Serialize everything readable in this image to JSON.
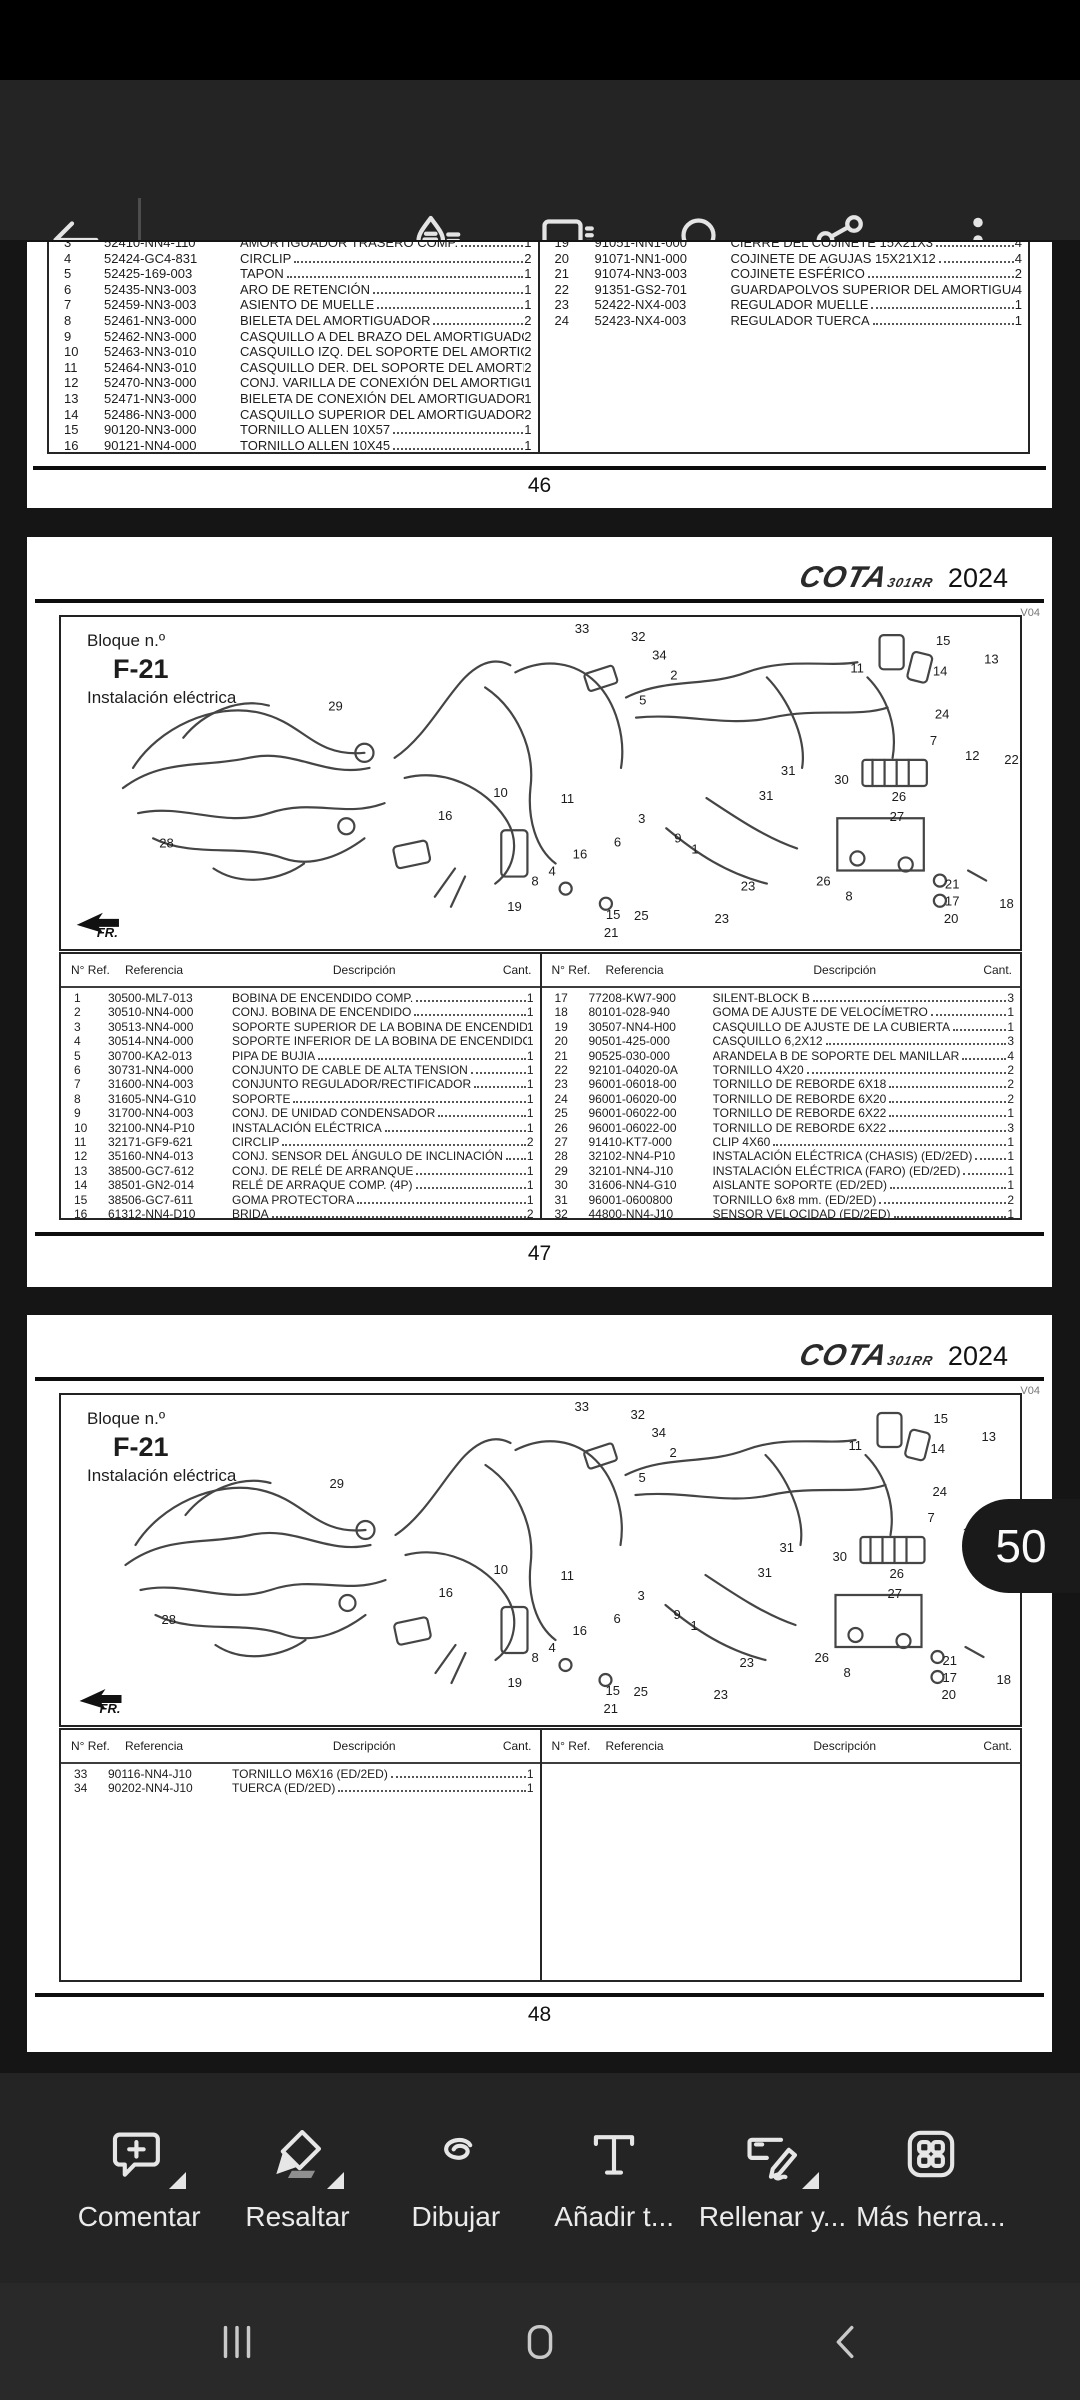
{
  "top_toolbar": {
    "icons": [
      "back-icon",
      "annotations-icon",
      "comments-icon",
      "search-icon",
      "share-icon",
      "overflow-menu-icon"
    ]
  },
  "table_headers": {
    "num": "N° Ref.",
    "ref": "Referencia",
    "desc": "Descripción",
    "qty": "Cant."
  },
  "diagram": {
    "block_label": "Bloque n.º",
    "block_code": "F-21",
    "block_title": "Instalación eléctrica",
    "brand": "COTA",
    "brand_sub": "301RR",
    "year": "2024",
    "version": "V04",
    "fr_label": "FR.",
    "callouts": [
      {
        "n": "33",
        "x": 509,
        "y": 16
      },
      {
        "n": "32",
        "x": 565,
        "y": 24
      },
      {
        "n": "34",
        "x": 586,
        "y": 42
      },
      {
        "n": "2",
        "x": 604,
        "y": 62
      },
      {
        "n": "15",
        "x": 868,
        "y": 28
      },
      {
        "n": "13",
        "x": 916,
        "y": 46
      },
      {
        "n": "11",
        "x": 783,
        "y": 55
      },
      {
        "n": "14",
        "x": 865,
        "y": 58
      },
      {
        "n": "5",
        "x": 573,
        "y": 87
      },
      {
        "n": "29",
        "x": 264,
        "y": 93
      },
      {
        "n": "24",
        "x": 867,
        "y": 101
      },
      {
        "n": "7",
        "x": 862,
        "y": 127
      },
      {
        "n": "12",
        "x": 897,
        "y": 142
      },
      {
        "n": "22",
        "x": 936,
        "y": 146
      },
      {
        "n": "31",
        "x": 714,
        "y": 157
      },
      {
        "n": "30",
        "x": 767,
        "y": 166
      },
      {
        "n": "31",
        "x": 692,
        "y": 182
      },
      {
        "n": "26",
        "x": 824,
        "y": 183
      },
      {
        "n": "27",
        "x": 822,
        "y": 203
      },
      {
        "n": "10",
        "x": 428,
        "y": 179
      },
      {
        "n": "16",
        "x": 373,
        "y": 202
      },
      {
        "n": "11",
        "x": 495,
        "y": 185
      },
      {
        "n": "3",
        "x": 572,
        "y": 205
      },
      {
        "n": "9",
        "x": 608,
        "y": 224
      },
      {
        "n": "1",
        "x": 625,
        "y": 235
      },
      {
        "n": "6",
        "x": 548,
        "y": 228
      },
      {
        "n": "28",
        "x": 96,
        "y": 229
      },
      {
        "n": "16",
        "x": 507,
        "y": 240
      },
      {
        "n": "4",
        "x": 483,
        "y": 257
      },
      {
        "n": "8",
        "x": 466,
        "y": 267
      },
      {
        "n": "19",
        "x": 442,
        "y": 292
      },
      {
        "n": "15",
        "x": 540,
        "y": 300
      },
      {
        "n": "25",
        "x": 568,
        "y": 301
      },
      {
        "n": "21",
        "x": 538,
        "y": 318
      },
      {
        "n": "23",
        "x": 648,
        "y": 304
      },
      {
        "n": "23",
        "x": 674,
        "y": 272
      },
      {
        "n": "26",
        "x": 749,
        "y": 267
      },
      {
        "n": "8",
        "x": 778,
        "y": 282
      },
      {
        "n": "21",
        "x": 877,
        "y": 270
      },
      {
        "n": "17",
        "x": 877,
        "y": 287
      },
      {
        "n": "20",
        "x": 876,
        "y": 304
      },
      {
        "n": "18",
        "x": 931,
        "y": 289
      }
    ]
  },
  "page46": {
    "number": "46",
    "left_rows": [
      [
        "3",
        "52410-NN4-110",
        "AMORTIGUADOR TRASERO COMP.",
        "1"
      ],
      [
        "4",
        "52424-GC4-831",
        "CIRCLIP",
        "2"
      ],
      [
        "5",
        "52425-169-003",
        "TAPON",
        "1"
      ],
      [
        "6",
        "52435-NN3-003",
        "ARO DE RETENCIÓN",
        "1"
      ],
      [
        "7",
        "52459-NN3-003",
        "ASIENTO DE MUELLE",
        "1"
      ],
      [
        "8",
        "52461-NN3-000",
        "BIELETA DEL AMORTIGUADOR",
        "2"
      ],
      [
        "9",
        "52462-NN3-000",
        "CASQUILLO A DEL BRAZO DEL AMORTIGUADOR",
        "2"
      ],
      [
        "10",
        "52463-NN3-010",
        "CASQUILLO IZQ. DEL SOPORTE DEL AMORTIGUADOR",
        "2"
      ],
      [
        "11",
        "52464-NN3-010",
        "CASQUILLO DER. DEL SOPORTE DEL AMORTIGUADOR",
        "2"
      ],
      [
        "12",
        "52470-NN3-000",
        "CONJ. VARILLA DE CONEXIÓN DEL AMORTIGUADOR",
        "1"
      ],
      [
        "13",
        "52471-NN3-000",
        "BIELETA DE CONEXIÓN DEL AMORTIGUADOR",
        "1"
      ],
      [
        "14",
        "52486-NN3-000",
        "CASQUILLO SUPERIOR DEL AMORTIGUADOR",
        "2"
      ],
      [
        "15",
        "90120-NN3-000",
        "TORNILLO ALLEN 10X57",
        "1"
      ],
      [
        "16",
        "90121-NN4-000",
        "TORNILLO ALLEN 10X45",
        "1"
      ]
    ],
    "right_rows": [
      [
        "19",
        "91051-NN1-000",
        "CIERRE DEL COJINETE 15X21X3",
        "4"
      ],
      [
        "20",
        "91071-NN1-000",
        "COJINETE DE AGUJAS 15X21X12",
        "4"
      ],
      [
        "21",
        "91074-NN3-003",
        "COJINETE ESFÉRICO",
        "2"
      ],
      [
        "22",
        "91351-GS2-701",
        "GUARDAPOLVOS SUPERIOR DEL AMORTIGUADOR",
        "4"
      ],
      [
        "23",
        "52422-NX4-003",
        "REGULADOR MUELLE",
        "1"
      ],
      [
        "24",
        "52423-NX4-003",
        "REGULADOR TUERCA",
        "1"
      ]
    ]
  },
  "page47": {
    "number": "47",
    "left_rows": [
      [
        "1",
        "30500-ML7-013",
        "BOBINA DE ENCENDIDO COMP.",
        "1"
      ],
      [
        "2",
        "30510-NN4-000",
        "CONJ. BOBINA DE ENCENDIDO",
        "1"
      ],
      [
        "3",
        "30513-NN4-000",
        "SOPORTE SUPERIOR DE LA BOBINA DE ENCENDIDO",
        "1"
      ],
      [
        "4",
        "30514-NN4-000",
        "SOPORTE INFERIOR DE LA BOBINA DE ENCENDIDO",
        "1"
      ],
      [
        "5",
        "30700-KA2-013",
        "PIPA DE BUJIA",
        "1"
      ],
      [
        "6",
        "30731-NN4-000",
        "CONJUNTO DE CABLE DE ALTA TENSION",
        "1"
      ],
      [
        "7",
        "31600-NN4-003",
        "CONJUNTO REGULADOR/RECTIFICADOR",
        "1"
      ],
      [
        "8",
        "31605-NN4-G10",
        "SOPORTE",
        "1"
      ],
      [
        "9",
        "31700-NN4-003",
        "CONJ. DE UNIDAD CONDENSADOR",
        "1"
      ],
      [
        "10",
        "32100-NN4-P10",
        "INSTALACIÓN ELÉCTRICA",
        "1"
      ],
      [
        "11",
        "32171-GF9-621",
        "CIRCLIP",
        "2"
      ],
      [
        "12",
        "35160-NN4-013",
        "CONJ. SENSOR DEL ÁNGULO DE INCLINACIÓN",
        "1"
      ],
      [
        "13",
        "38500-GC7-612",
        "CONJ. DE RELÉ DE ARRANQUE",
        "1"
      ],
      [
        "14",
        "38501-GN2-014",
        "RELÉ DE ARRAQUE COMP. (4P)",
        "1"
      ],
      [
        "15",
        "38506-GC7-611",
        "GOMA PROTECTORA",
        "1"
      ],
      [
        "16",
        "61312-NN4-D10",
        "BRIDA",
        "2"
      ]
    ],
    "right_rows": [
      [
        "17",
        "77208-KW7-900",
        "SILENT-BLOCK B",
        "3"
      ],
      [
        "18",
        "80101-028-940",
        "GOMA DE AJUSTE DE VELOCÍMETRO",
        "1"
      ],
      [
        "19",
        "30507-NN4-H00",
        "CASQUILLO DE AJUSTE DE LA CUBIERTA",
        "1"
      ],
      [
        "20",
        "90501-425-000",
        "CASQUILLO 6,2X12",
        "3"
      ],
      [
        "21",
        "90525-030-000",
        "ARANDELA B DE SOPORTE DEL MANILLAR",
        "4"
      ],
      [
        "22",
        "92101-04020-0A",
        "TORNILLO 4X20",
        "2"
      ],
      [
        "23",
        "96001-06018-00",
        "TORNILLO DE REBORDE 6X18",
        "2"
      ],
      [
        "24",
        "96001-06020-00",
        "TORNILLO DE REBORDE 6X20",
        "2"
      ],
      [
        "25",
        "96001-06022-00",
        "TORNILLO DE REBORDE 6X22",
        "1"
      ],
      [
        "26",
        "96001-06022-00",
        "TORNILLO DE REBORDE 6X22",
        "3"
      ],
      [
        "27",
        "91410-KT7-000",
        "CLIP 4X60",
        "1"
      ],
      [
        "28",
        "32102-NN4-P10",
        "INSTALACIÓN ELÉCTRICA (CHASIS) (ED/2ED)",
        "1"
      ],
      [
        "29",
        "32101-NN4-J10",
        "INSTALACIÓN ELÉCTRICA (FARO) (ED/2ED)",
        "1"
      ],
      [
        "30",
        "31606-NN4-G10",
        "AISLANTE SOPORTE (ED/2ED)",
        "1"
      ],
      [
        "31",
        "96001-0600800",
        "TORNILLO 6x8 mm. (ED/2ED)",
        "2"
      ],
      [
        "32",
        "44800-NN4-J10",
        "SENSOR VELOCIDAD (ED/2ED)",
        "1"
      ]
    ]
  },
  "page48": {
    "number": "48",
    "left_rows": [
      [
        "33",
        "90116-NN4-J10",
        "TORNILLO M6X16 (ED/2ED)",
        "1"
      ],
      [
        "34",
        "90202-NN4-J10",
        "TUERCA (ED/2ED)",
        "1"
      ]
    ],
    "right_rows": []
  },
  "page_indicator": {
    "value": "50"
  },
  "bottom_toolbar": {
    "items": [
      {
        "label": "Comentar",
        "icon": "comment-add-icon",
        "menu": true
      },
      {
        "label": "Resaltar",
        "icon": "highlight-icon",
        "menu": true
      },
      {
        "label": "Dibujar",
        "icon": "draw-icon",
        "menu": false
      },
      {
        "label": "Añadir t...",
        "icon": "add-text-icon",
        "menu": false
      },
      {
        "label": "Rellenar y...",
        "icon": "fill-sign-icon",
        "menu": true
      },
      {
        "label": "Más herra...",
        "icon": "more-tools-icon",
        "menu": false
      }
    ]
  },
  "nav_bar": {
    "icons": [
      "recents-icon",
      "home-icon",
      "back-icon"
    ]
  },
  "colors": {
    "toolbar_bg": "#242424",
    "viewer_bg": "#151515",
    "page_bg": "#ffffff",
    "indicator_bg": "#1a1a1a",
    "navbar_bg": "#292929",
    "icon": "#e4e4e4"
  }
}
